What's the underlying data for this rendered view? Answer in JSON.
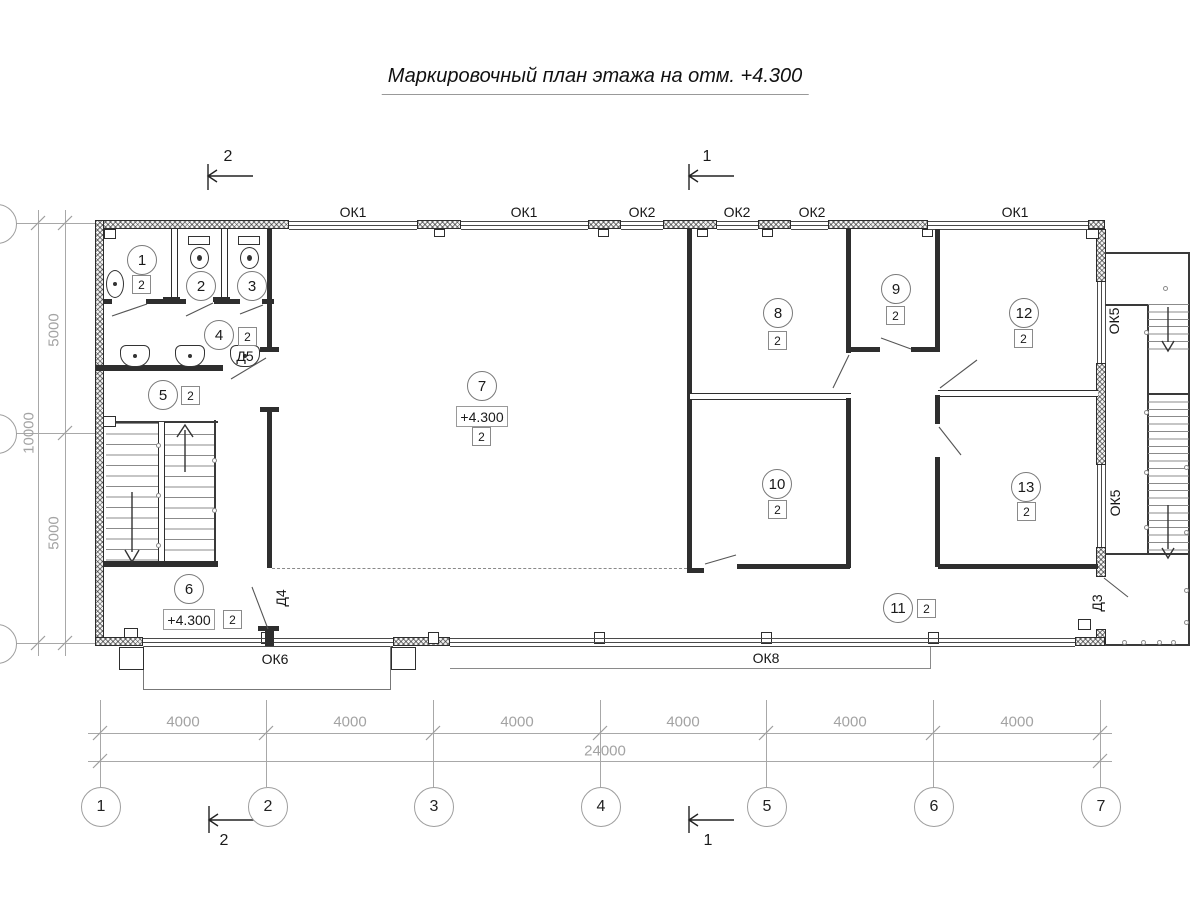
{
  "title": "Маркировочный план этажа на отм. +4.300",
  "sections": {
    "top_left": "2",
    "top_right": "1",
    "bottom_left": "2",
    "bottom_right": "1"
  },
  "windows": {
    "top": [
      "ОК1",
      "ОК1",
      "ОК2",
      "ОК2",
      "ОК2",
      "ОК1"
    ],
    "right": [
      "ОК5",
      "ОК5"
    ],
    "bottom": [
      "ОК6",
      "ОК8"
    ]
  },
  "doors": [
    "Д5",
    "Д4",
    "Д3"
  ],
  "rooms": [
    {
      "num": "1",
      "finish": "2"
    },
    {
      "num": "2"
    },
    {
      "num": "3"
    },
    {
      "num": "4",
      "finish": "2"
    },
    {
      "num": "5",
      "finish": "2"
    },
    {
      "num": "6",
      "finish": "2",
      "elevation": "+4.300"
    },
    {
      "num": "7",
      "finish": "2",
      "elevation": "+4.300"
    },
    {
      "num": "8",
      "finish": "2"
    },
    {
      "num": "9",
      "finish": "2"
    },
    {
      "num": "10",
      "finish": "2"
    },
    {
      "num": "11",
      "finish": "2"
    },
    {
      "num": "12",
      "finish": "2"
    },
    {
      "num": "13",
      "finish": "2"
    }
  ],
  "axes": {
    "bottom": [
      "1",
      "2",
      "3",
      "4",
      "5",
      "6",
      "7"
    ]
  },
  "dims": {
    "bottom": [
      "4000",
      "4000",
      "4000",
      "4000",
      "4000",
      "4000"
    ],
    "total": "24000",
    "left": [
      "5000",
      "10000",
      "5000"
    ]
  }
}
